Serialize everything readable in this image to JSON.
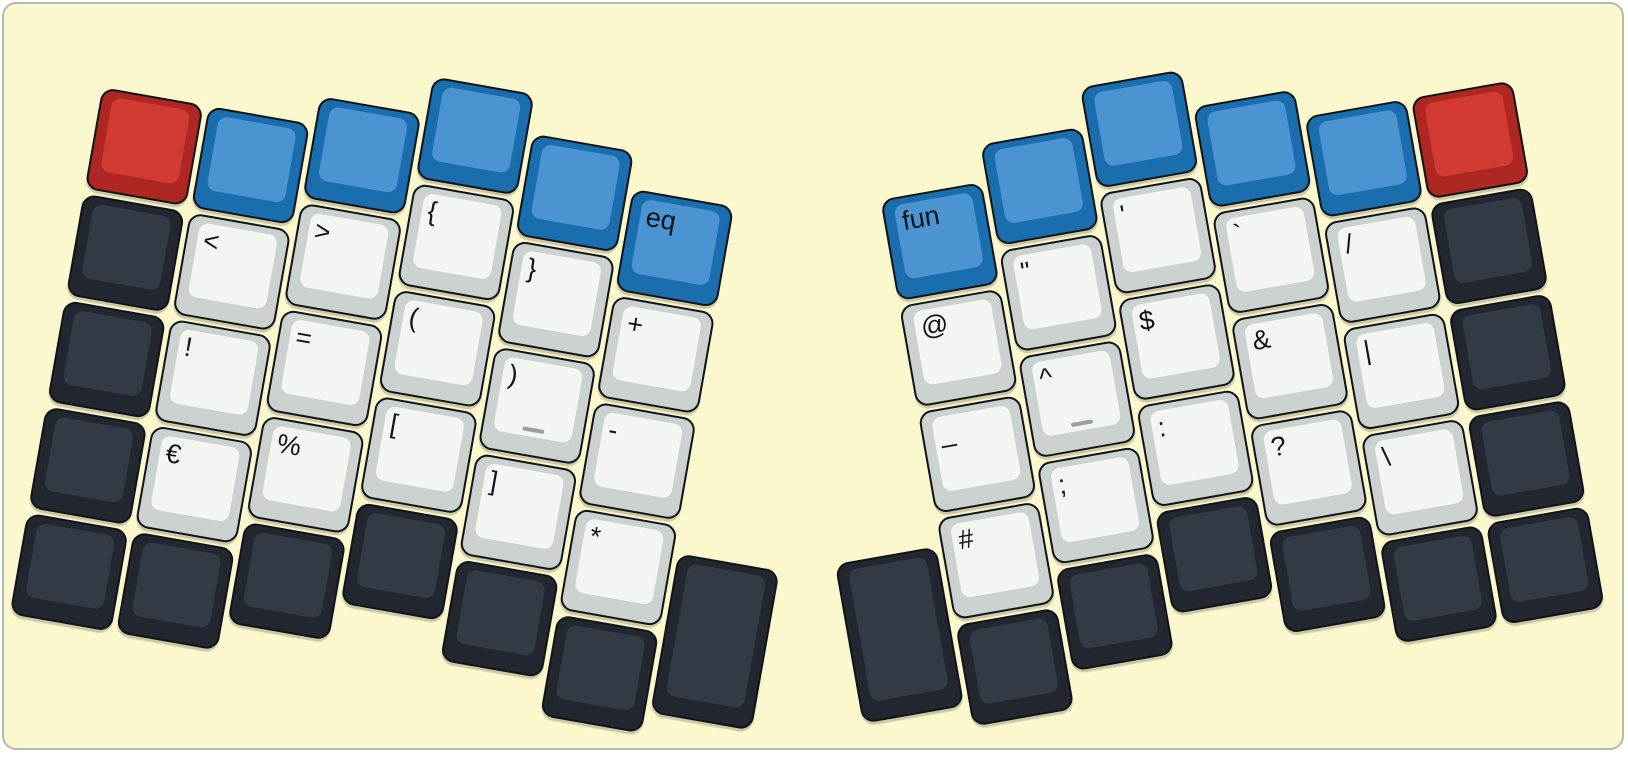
{
  "app": {
    "type": "split-keyboard-layout-view",
    "panel": {
      "bg": "#FBF8CE",
      "border": "#b3bab3",
      "outer_bg": "#ffffff"
    }
  },
  "colors": {
    "red": {
      "base": "#AE2722",
      "top": "#D23B32"
    },
    "blue": {
      "base": "#1A6EAE",
      "top": "#4B93D1"
    },
    "dark": {
      "base": "#23272F",
      "top": "#343B47"
    },
    "white": {
      "base": "#CBD1CF",
      "top": "#F2F5F1"
    },
    "outline": "#111418",
    "legend": "#131319",
    "homing_bar": "#9aa09e"
  },
  "keyboard": {
    "unit": 108,
    "key_size": 103,
    "halves": [
      {
        "id": "half-left",
        "name": "left",
        "rotation": 10,
        "origin": {
          "x": 0,
          "y": 0
        },
        "col_x": [
          116,
          224,
          332,
          440,
          548,
          656
        ],
        "col_y": [
          68,
          68,
          39,
          0,
          39,
          76
        ],
        "keys": [
          {
            "c": 1,
            "r": 1,
            "color": "red",
            "name": "red-blank"
          },
          {
            "c": 1,
            "r": 2,
            "color": "dark",
            "name": "dark-blank"
          },
          {
            "c": 1,
            "r": 3,
            "color": "dark",
            "name": "dark-blank"
          },
          {
            "c": 1,
            "r": 4,
            "color": "dark",
            "name": "dark-blank"
          },
          {
            "c": 1,
            "r": 5,
            "color": "dark",
            "name": "dark-blank"
          },
          {
            "c": 2,
            "r": 1,
            "color": "blue",
            "name": "blue-blank"
          },
          {
            "c": 2,
            "r": 2,
            "color": "white",
            "label": "<",
            "name": "less-than"
          },
          {
            "c": 2,
            "r": 3,
            "color": "white",
            "label": "!",
            "name": "exclamation"
          },
          {
            "c": 2,
            "r": 4,
            "color": "white",
            "label": "€",
            "name": "euro"
          },
          {
            "c": 2,
            "r": 5,
            "color": "dark",
            "name": "dark-blank"
          },
          {
            "c": 3,
            "r": 1,
            "color": "blue",
            "name": "blue-blank"
          },
          {
            "c": 3,
            "r": 2,
            "color": "white",
            "label": ">",
            "name": "greater-than"
          },
          {
            "c": 3,
            "r": 3,
            "color": "white",
            "label": "=",
            "name": "equals"
          },
          {
            "c": 3,
            "r": 4,
            "color": "white",
            "label": "%",
            "name": "percent"
          },
          {
            "c": 3,
            "r": 5,
            "color": "dark",
            "name": "dark-blank"
          },
          {
            "c": 4,
            "r": 1,
            "color": "blue",
            "name": "blue-blank"
          },
          {
            "c": 4,
            "r": 2,
            "color": "white",
            "label": "{",
            "name": "open-brace"
          },
          {
            "c": 4,
            "r": 3,
            "color": "white",
            "label": "(",
            "name": "open-paren"
          },
          {
            "c": 4,
            "r": 4,
            "color": "white",
            "label": "[",
            "name": "open-bracket"
          },
          {
            "c": 4,
            "r": 5,
            "color": "dark",
            "name": "dark-blank"
          },
          {
            "c": 5,
            "r": 1,
            "color": "blue",
            "name": "blue-blank"
          },
          {
            "c": 5,
            "r": 2,
            "color": "white",
            "label": "}",
            "name": "close-brace"
          },
          {
            "c": 5,
            "r": 3,
            "color": "white",
            "label": ")",
            "homing": true,
            "name": "close-paren"
          },
          {
            "c": 5,
            "r": 4,
            "color": "white",
            "label": "]",
            "name": "close-bracket"
          },
          {
            "c": 5,
            "r": 5,
            "color": "dark",
            "name": "dark-blank"
          },
          {
            "c": 6,
            "r": 1,
            "color": "blue",
            "label": "eq",
            "name": "eq-layer"
          },
          {
            "c": 6,
            "r": 2,
            "color": "white",
            "label": "+",
            "name": "plus"
          },
          {
            "c": 6,
            "r": 3,
            "color": "white",
            "label": "-",
            "name": "minus"
          },
          {
            "c": 6,
            "r": 4,
            "color": "white",
            "label": "*",
            "name": "asterisk"
          },
          {
            "c": 6,
            "r": 5,
            "color": "dark",
            "name": "dark-blank"
          },
          {
            "x": 764,
            "y": 427,
            "h": 162,
            "color": "dark",
            "name": "thumb-dark-blank"
          }
        ]
      },
      {
        "id": "half-right",
        "name": "right",
        "rotation": -10,
        "origin": {
          "x": 867,
          "y": 125
        },
        "col_x": [
          0,
          108,
          216,
          324,
          432,
          540
        ],
        "col_y": [
          76,
          39,
          0,
          39,
          68,
          68
        ],
        "keys": [
          {
            "c": 1,
            "r": 1,
            "color": "blue",
            "label": "fun",
            "name": "fun-layer"
          },
          {
            "c": 1,
            "r": 2,
            "color": "white",
            "label": "@",
            "name": "at-sign"
          },
          {
            "c": 1,
            "r": 3,
            "color": "white",
            "label": "_",
            "name": "underscore"
          },
          {
            "c": 1,
            "r": 4,
            "color": "white",
            "label": "#",
            "name": "hash"
          },
          {
            "c": 1,
            "r": 5,
            "color": "dark",
            "name": "dark-blank"
          },
          {
            "c": 2,
            "r": 1,
            "color": "blue",
            "name": "blue-blank"
          },
          {
            "c": 2,
            "r": 2,
            "color": "white",
            "label": "\"",
            "name": "double-quote"
          },
          {
            "c": 2,
            "r": 3,
            "color": "white",
            "label": "^",
            "homing": true,
            "name": "caret"
          },
          {
            "c": 2,
            "r": 4,
            "color": "white",
            "label": ";",
            "name": "semicolon"
          },
          {
            "c": 2,
            "r": 5,
            "color": "dark",
            "name": "dark-blank"
          },
          {
            "c": 3,
            "r": 1,
            "color": "blue",
            "name": "blue-blank"
          },
          {
            "c": 3,
            "r": 2,
            "color": "white",
            "label": "'",
            "name": "apostrophe"
          },
          {
            "c": 3,
            "r": 3,
            "color": "white",
            "label": "$",
            "name": "dollar"
          },
          {
            "c": 3,
            "r": 4,
            "color": "white",
            "label": ":",
            "name": "colon"
          },
          {
            "c": 3,
            "r": 5,
            "color": "dark",
            "name": "dark-blank"
          },
          {
            "c": 4,
            "r": 1,
            "color": "blue",
            "name": "blue-blank"
          },
          {
            "c": 4,
            "r": 2,
            "color": "white",
            "label": "`",
            "name": "backtick"
          },
          {
            "c": 4,
            "r": 3,
            "color": "white",
            "label": "&",
            "name": "ampersand"
          },
          {
            "c": 4,
            "r": 4,
            "color": "white",
            "label": "?",
            "name": "question"
          },
          {
            "c": 4,
            "r": 5,
            "color": "dark",
            "name": "dark-blank"
          },
          {
            "c": 5,
            "r": 1,
            "color": "blue",
            "name": "blue-blank"
          },
          {
            "c": 5,
            "r": 2,
            "color": "white",
            "label": "/",
            "name": "slash"
          },
          {
            "c": 5,
            "r": 3,
            "color": "white",
            "label": "|",
            "name": "pipe"
          },
          {
            "c": 5,
            "r": 4,
            "color": "white",
            "label": "\\",
            "name": "backslash"
          },
          {
            "c": 5,
            "r": 5,
            "color": "dark",
            "name": "dark-blank"
          },
          {
            "c": 6,
            "r": 1,
            "color": "red",
            "name": "red-blank"
          },
          {
            "c": 6,
            "r": 2,
            "color": "dark",
            "name": "dark-blank"
          },
          {
            "c": 6,
            "r": 3,
            "color": "dark",
            "name": "dark-blank"
          },
          {
            "c": 6,
            "r": 4,
            "color": "dark",
            "name": "dark-blank"
          },
          {
            "c": 6,
            "r": 5,
            "color": "dark",
            "name": "dark-blank"
          },
          {
            "x": -108,
            "y": 427,
            "h": 162,
            "color": "dark",
            "name": "thumb-dark-blank"
          }
        ]
      }
    ]
  }
}
